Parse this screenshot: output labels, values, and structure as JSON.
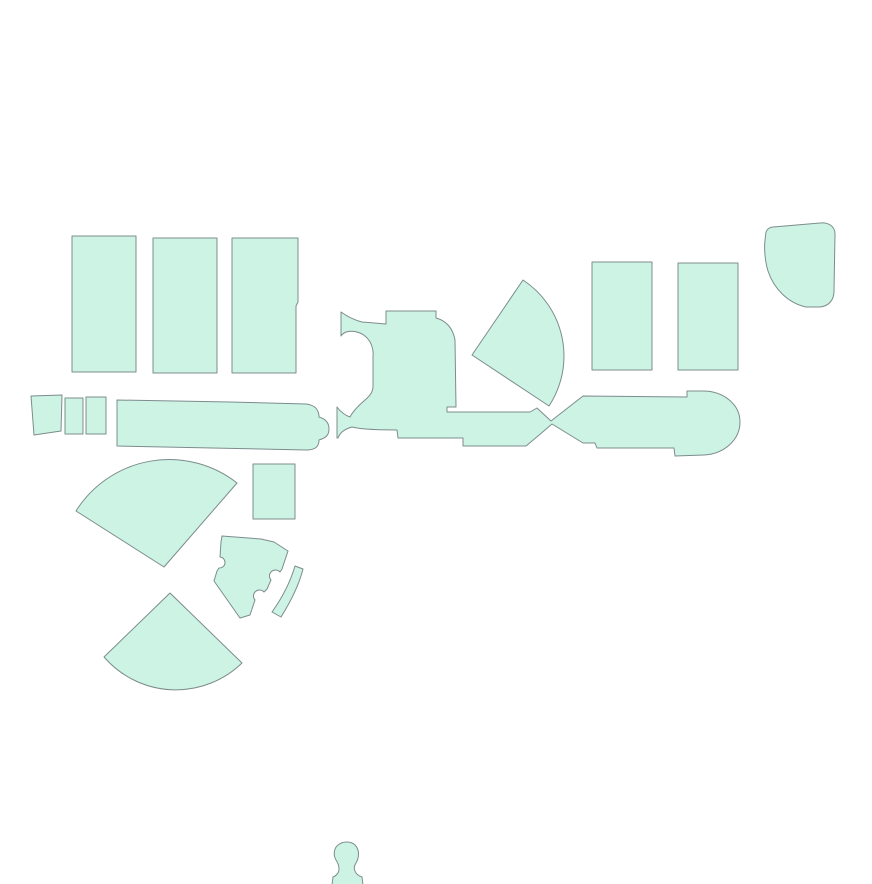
{
  "canvas": {
    "width": 872,
    "height": 884,
    "background": "#ffffff"
  },
  "palette": {
    "region_fill": "#cdf3e5",
    "region_stroke": "#7c8c8c"
  },
  "regions": [
    {
      "id": "block-northwest-1",
      "d": "M72,236 L136,236 L136,372 L72,372 Z"
    },
    {
      "id": "block-northwest-2",
      "d": "M153,238 L217,238 L217,373 L153,373 Z"
    },
    {
      "id": "block-northwest-3",
      "d": "M232,238 L298,238 L298,302 L296,306 L296,373 L232,373 Z"
    },
    {
      "id": "block-northeast-1",
      "d": "M592,262 L652,262 L652,370 L592,370 Z"
    },
    {
      "id": "block-northeast-2",
      "d": "M678,263 L738,263 L738,370 L678,370 Z"
    },
    {
      "id": "blob-corner-northeast",
      "d": "M773,227 L820,223 C828,222 835,226 835,234 L834,291 C834,300 829,306 820,307 L806,307 C788,303 774,289 768,271 C765,261 764,249 765,240 L766,232 C767,229 770,227 773,227 Z"
    },
    {
      "id": "fan-central",
      "d": "M472,355 L523,280 A91,91 0 0 1 549,406 Z"
    },
    {
      "id": "small-block-west-1",
      "d": "M31,396 L62,395 L61,431 L34,435 Z"
    },
    {
      "id": "small-block-west-2",
      "d": "M65,398 L83,398 L83,434 L65,434 Z"
    },
    {
      "id": "small-block-west-3",
      "d": "M86,397 L106,397 L106,434 L86,434 Z"
    },
    {
      "id": "concourse-west",
      "d": "M117,400 L230,402 L306,404 C315,405 319,410 319,417 C326,419 329,423 329,429 C329,435 326,438 319,440 C319,447 315,450 306,450 L117,446 Z"
    },
    {
      "id": "concourse-central-east",
      "d": "M341,312 C348,317 354,320 362,322 L386,324 L386,311 L436,311 L436,318 C447,321 453,329 455,340 L456,407 L447,407 L447,412 L530,412 L537,408 L551,421 L583,396 L687,397 L687,391 L703,391 C723,391 740,404 740,422 C740,440 724,454 704,455 L675,456 L674,448 L597,448 L595,443 L583,443 L552,424 L538,436 L526,446 L463,446 L463,438 L398,438 L397,430 C377,430 360,429 352,427 C345,429 340,432 338,438 L337,438 L337,407 C340,411 344,415 350,417 C353,411 358,406 365,400 C371,395 373,391 373,386 L373,357 C374,349 371,341 365,336 C360,332 352,330 346,332 C344,333 342,334 341,336 Z"
    },
    {
      "id": "fan-west",
      "d": "M164,567 L76,511 A110,110 0 0 1 237,483 Z"
    },
    {
      "id": "small-block-center",
      "d": "M253,464 L295,464 L295,519 L253,519 Z"
    },
    {
      "id": "block-notched",
      "d": "M222,536 L261,539 L274,542 L288,551 L282,569 L280,572 A5.5,5.5 0 0 0 271,580 L267,589 L264,592 A5.5,5.5 0 0 0 255,600 L250,615 L240,618 L214,581 L217,571 L219,568 A5.5,5.5 0 0 0 220,557 L221,542 Z"
    },
    {
      "id": "sliver-curved",
      "d": "M295,566 L303,569 C299,585 291,601 281,617 L272,612 C282,598 290,583 295,566 Z"
    },
    {
      "id": "fan-southwest",
      "d": "M170,593 L104,657 A95,95 0 0 0 242,663 Z"
    },
    {
      "id": "bust-south",
      "d": "M332,885 L333,877 C336,876 339,873 339,869 C339,866 338,863 336,860 C333,855 334,848 338,845 C343,841 351,841 355,845 C360,850 359,858 356,863 C354,866 354,869 355,871 C356,874 359,876 362,877 L363,885 Z"
    }
  ]
}
